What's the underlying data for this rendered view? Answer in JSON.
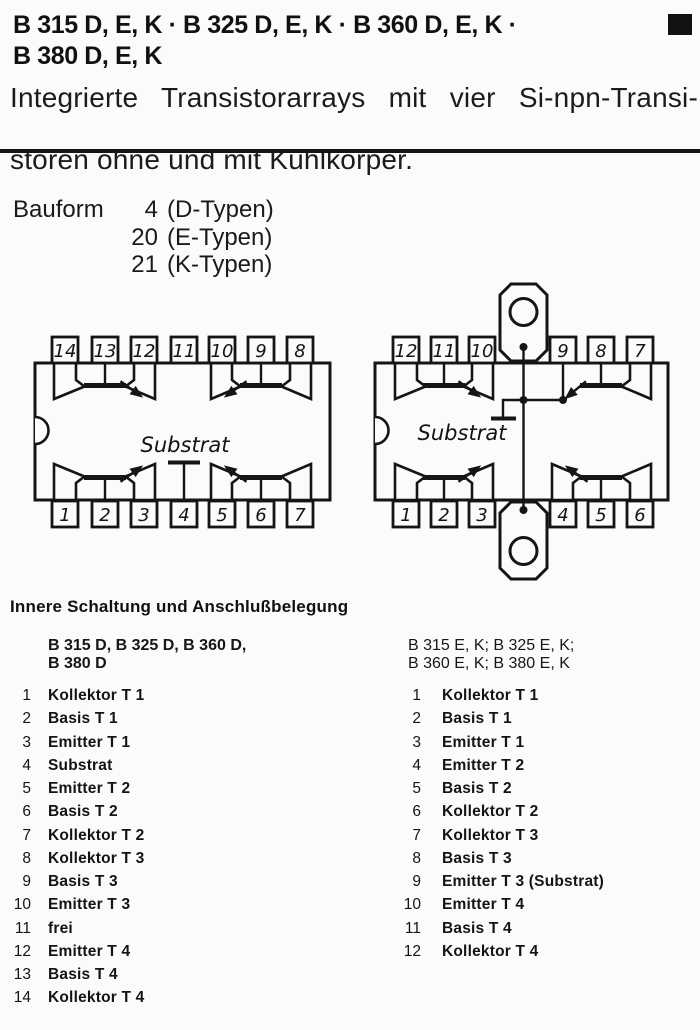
{
  "page": {
    "paper_color": "#fbfbf9",
    "ink_color": "#161616"
  },
  "header": {
    "title_line1": "B 315 D, E, K · B 325 D, E, K · B 360 D, E, K ·",
    "title_line2": "B 380 D, E, K",
    "subtitle_line1": "Integrierte Transistorarrays mit vier Si-npn-Transi-",
    "subtitle_line2": "storen ohne und mit Kühlkörper."
  },
  "bauform": {
    "label": "Bauform",
    "rows": [
      {
        "num": "4",
        "text": "(D-Typen)"
      },
      {
        "num": "20",
        "text": "(E-Typen)"
      },
      {
        "num": "21",
        "text": "(K-Typen)"
      }
    ]
  },
  "diagrams": {
    "left": {
      "substrate_label": "Substrat",
      "pins_top": [
        "14",
        "13",
        "12",
        "11",
        "10",
        "9",
        "8"
      ],
      "pins_bottom": [
        "1",
        "2",
        "3",
        "4",
        "5",
        "6",
        "7"
      ]
    },
    "right": {
      "substrate_label": "Substrat",
      "pins_top": [
        "12",
        "11",
        "10",
        "9",
        "8",
        "7"
      ],
      "pins_bottom": [
        "1",
        "2",
        "3",
        "4",
        "5",
        "6"
      ]
    }
  },
  "section": {
    "heading": "Innere Schaltung und Anschlußbelegung",
    "left_group": {
      "title_line1": "B 315 D, B 325 D, B 360 D,",
      "title_line2": "B 380 D",
      "pins": [
        {
          "num": "1",
          "label": "Kollektor T 1"
        },
        {
          "num": "2",
          "label": "Basis T 1"
        },
        {
          "num": "3",
          "label": "Emitter T 1"
        },
        {
          "num": "4",
          "label": "Substrat"
        },
        {
          "num": "5",
          "label": "Emitter T 2"
        },
        {
          "num": "6",
          "label": "Basis T 2"
        },
        {
          "num": "7",
          "label": "Kollektor T 2"
        },
        {
          "num": "8",
          "label": "Kollektor T 3"
        },
        {
          "num": "9",
          "label": "Basis T 3"
        },
        {
          "num": "10",
          "label": "Emitter T 3"
        },
        {
          "num": "11",
          "label": "frei"
        },
        {
          "num": "12",
          "label": "Emitter T 4"
        },
        {
          "num": "13",
          "label": "Basis T 4"
        },
        {
          "num": "14",
          "label": "Kollektor T 4"
        }
      ]
    },
    "right_group": {
      "title_line1": "B 315 E, K; B 325 E, K;",
      "title_line2": "B 360 E, K; B 380 E, K",
      "pins": [
        {
          "num": "1",
          "label": "Kollektor T 1"
        },
        {
          "num": "2",
          "label": "Basis T 1"
        },
        {
          "num": "3",
          "label": "Emitter T 1"
        },
        {
          "num": "4",
          "label": "Emitter T 2"
        },
        {
          "num": "5",
          "label": "Basis T 2"
        },
        {
          "num": "6",
          "label": "Kollektor T 2"
        },
        {
          "num": "7",
          "label": "Kollektor T 3"
        },
        {
          "num": "8",
          "label": "Basis T 3"
        },
        {
          "num": "9",
          "label": "Emitter T 3 (Substrat)"
        },
        {
          "num": "10",
          "label": "Emitter T 4"
        },
        {
          "num": "11",
          "label": "Basis T 4"
        },
        {
          "num": "12",
          "label": "Kollektor T 4"
        }
      ]
    }
  }
}
